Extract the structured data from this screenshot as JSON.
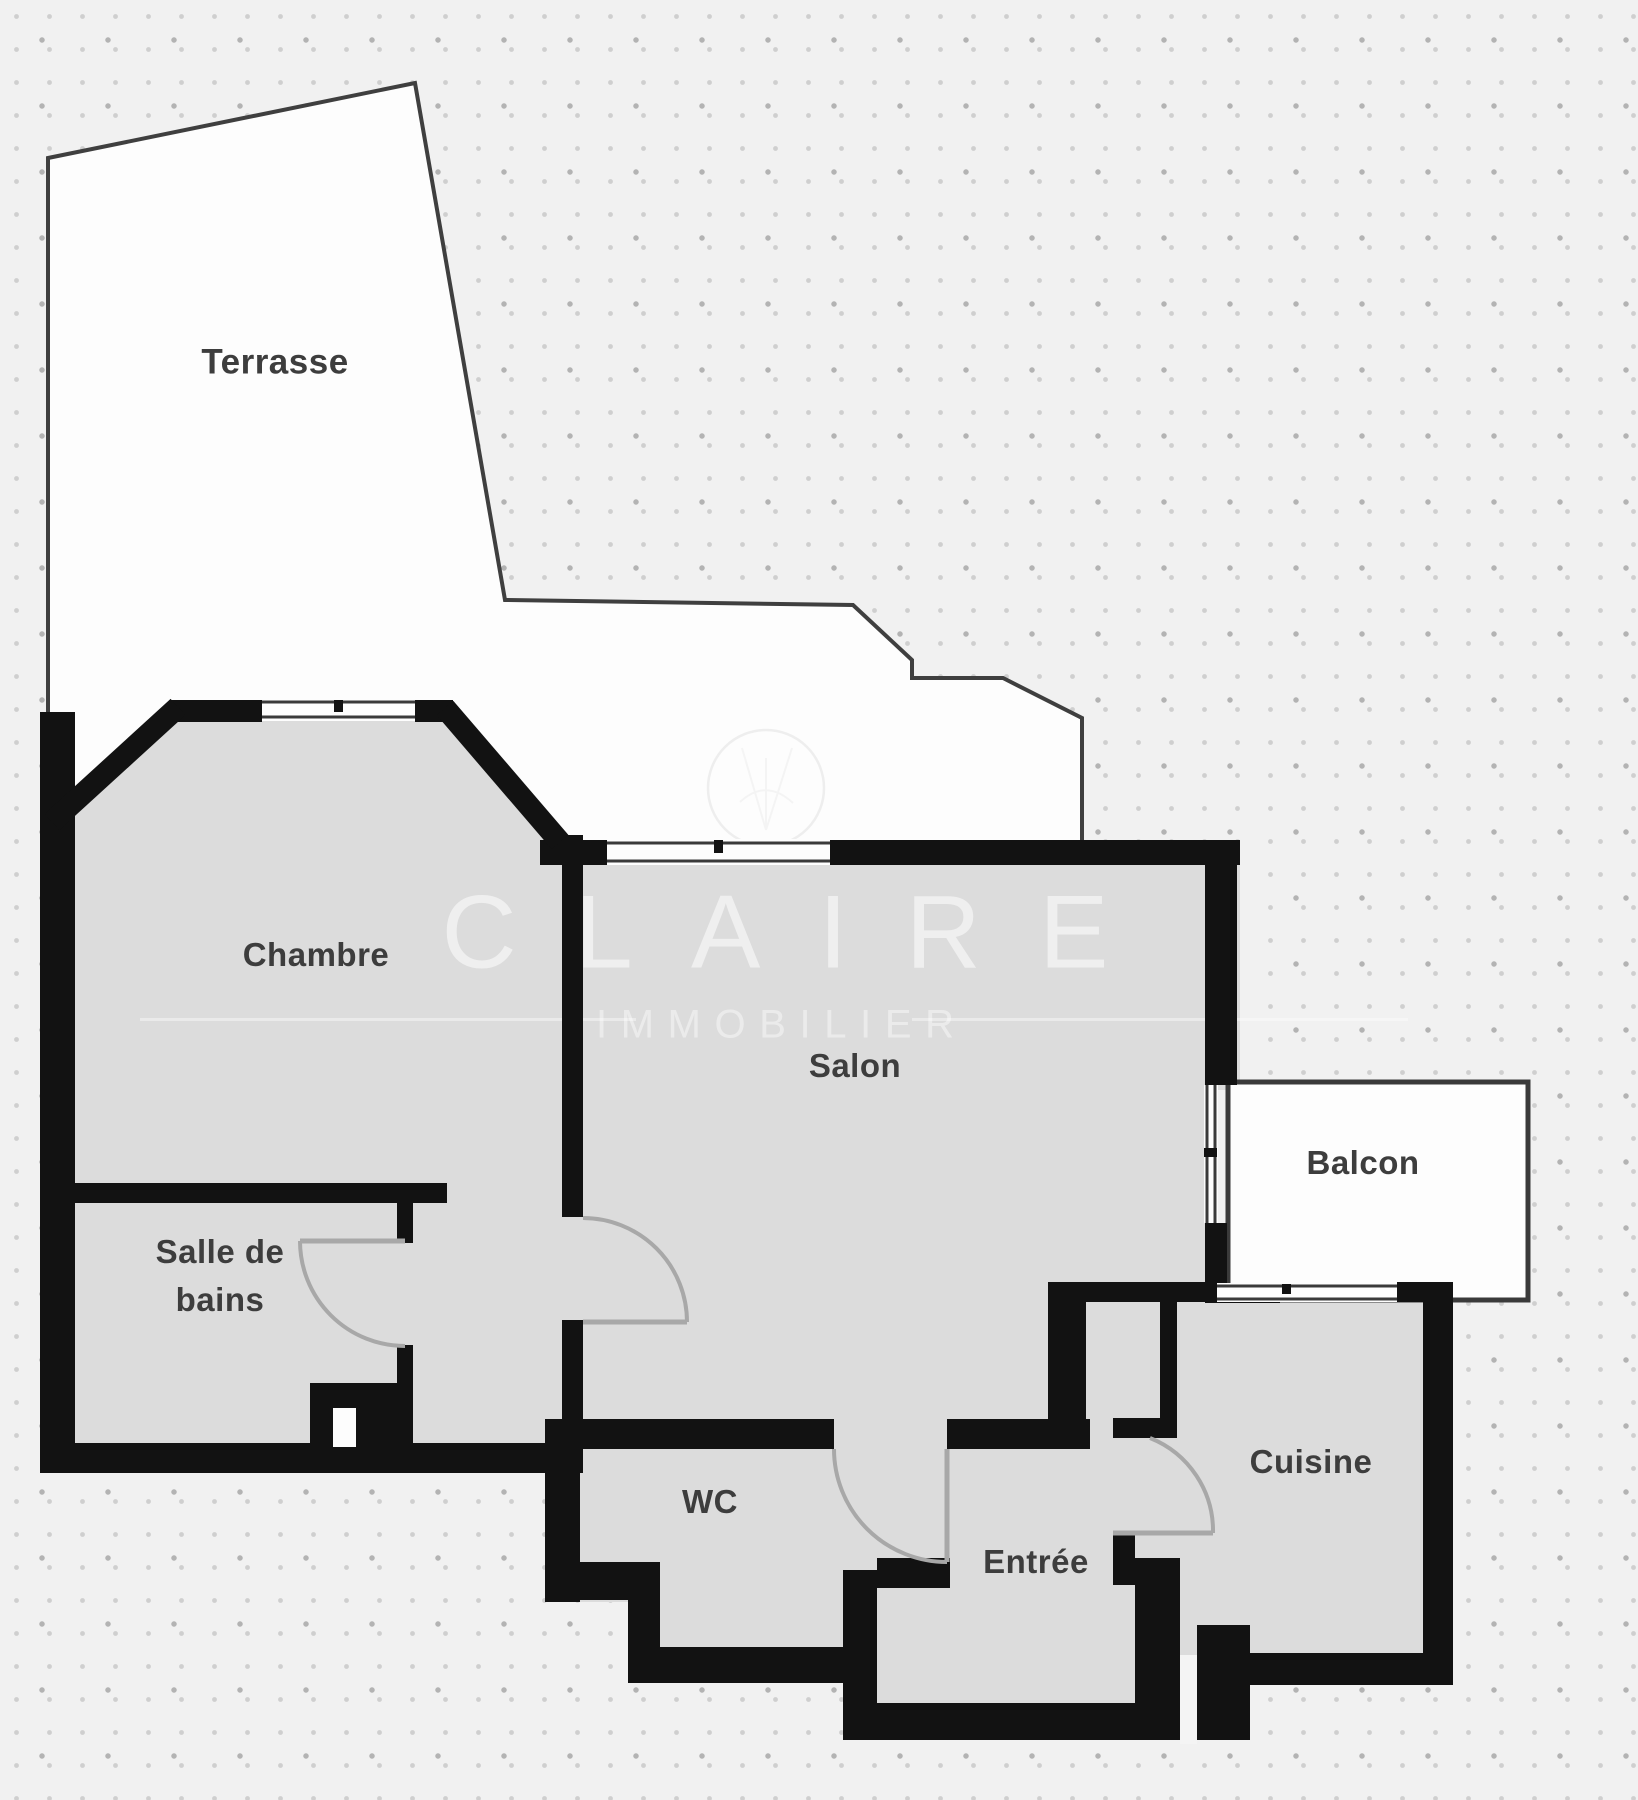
{
  "floorplan": {
    "rooms": [
      {
        "id": "terrasse",
        "label": "Terrasse"
      },
      {
        "id": "chambre",
        "label": "Chambre"
      },
      {
        "id": "salle-de-bains",
        "label": "Salle de bains",
        "line1": "Salle de",
        "line2": "bains"
      },
      {
        "id": "salon",
        "label": "Salon"
      },
      {
        "id": "balcon",
        "label": "Balcon"
      },
      {
        "id": "wc",
        "label": "WC"
      },
      {
        "id": "entree",
        "label": "Entrée"
      },
      {
        "id": "cuisine",
        "label": "Cuisine"
      }
    ],
    "watermark": {
      "brand": "CLAIRE",
      "tagline": "IMMOBILIER"
    },
    "colors": {
      "background": "#f1f1f1",
      "background_dot": "#c9c9c9",
      "wall": "#121212",
      "floor": "#dcdcdc",
      "outdoor_area": "#fdfdfd",
      "label_text": "#3d3d3d",
      "door_swing": "#a8a8a8",
      "watermark": "#ffffff"
    }
  }
}
